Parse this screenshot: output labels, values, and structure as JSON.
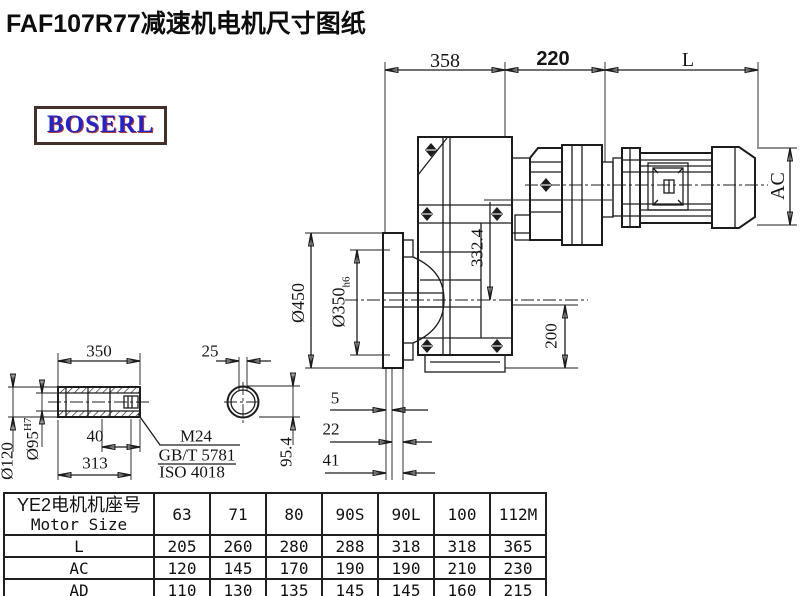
{
  "title": "FAF107R77减速机电机尺寸图纸",
  "logo": {
    "text": "BOSERL"
  },
  "drawing": {
    "dims": {
      "gearbox_width": "358",
      "adapter_width": "220",
      "motor_length": "L",
      "motor_diameter": "AC",
      "center_height": "332.4",
      "flange_od": "Ø450",
      "flange_spigot": "Ø350",
      "flange_spigot_tol": "h6",
      "axis_to_base": "200",
      "offset_a": "5",
      "offset_b": "22",
      "offset_c": "41",
      "shaft_length": "350",
      "keyway_width": "25",
      "shaft_od": "Ø120",
      "shaft_bore": "Ø95",
      "shaft_bore_tol": "H7",
      "keyway_height": "95.4",
      "recess_depth": "40",
      "bore_depth": "313",
      "thread": "M24",
      "standard_gb": "GB/T 5781",
      "standard_iso": "ISO 4018"
    }
  },
  "table": {
    "header_cn": "YE2电机机座号",
    "header_en": "Motor Size",
    "sizes": [
      "63",
      "71",
      "80",
      "90S",
      "90L",
      "100",
      "112M"
    ],
    "rows": [
      {
        "label": "L",
        "values": [
          "205",
          "260",
          "280",
          "288",
          "318",
          "318",
          "365"
        ]
      },
      {
        "label": "AC",
        "values": [
          "120",
          "145",
          "170",
          "190",
          "190",
          "210",
          "230"
        ]
      },
      {
        "label": "AD",
        "values": [
          "110",
          "130",
          "135",
          "145",
          "145",
          "160",
          "215"
        ]
      }
    ]
  }
}
